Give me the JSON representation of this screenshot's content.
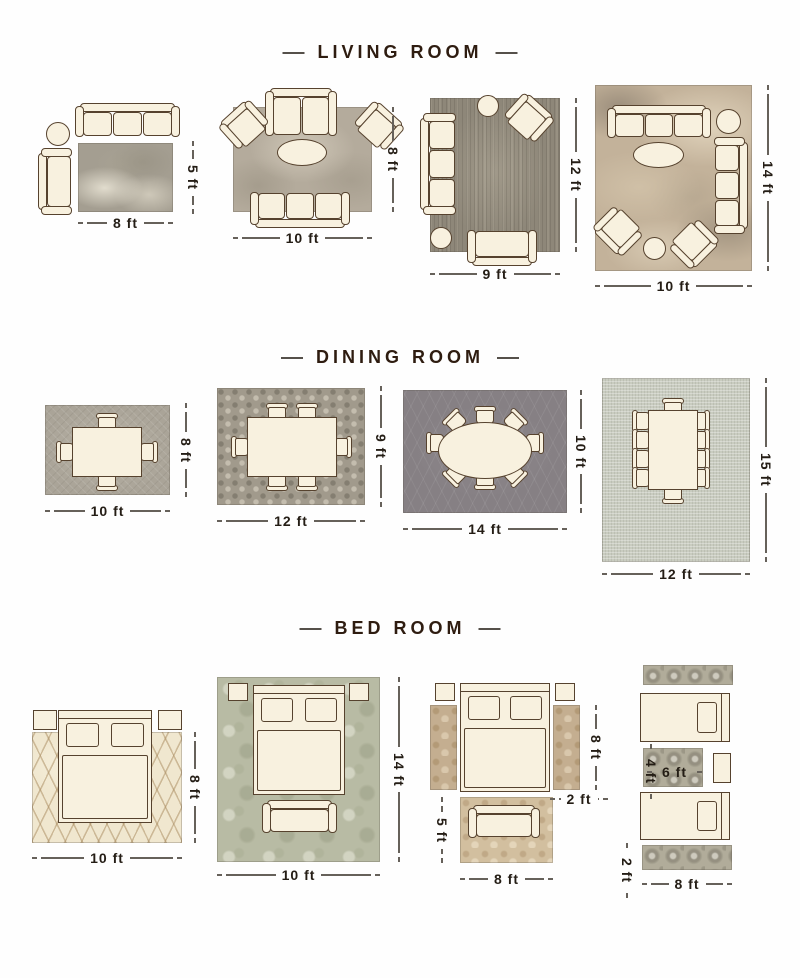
{
  "sections": [
    {
      "title": "LIVING ROOM",
      "layouts": [
        {
          "width": "8 ft",
          "height": "5 ft"
        },
        {
          "width": "10 ft",
          "height": "8 ft"
        },
        {
          "width": "9 ft",
          "height": "12 ft"
        },
        {
          "width": "10 ft",
          "height": "14 ft"
        }
      ]
    },
    {
      "title": "DINING ROOM",
      "layouts": [
        {
          "width": "10 ft",
          "height": "8 ft"
        },
        {
          "width": "12 ft",
          "height": "9 ft"
        },
        {
          "width": "14 ft",
          "height": "10 ft"
        },
        {
          "width": "12 ft",
          "height": "15 ft"
        }
      ]
    },
    {
      "title": "BED ROOM",
      "layouts": [
        {
          "width": "10 ft",
          "height": "8 ft"
        },
        {
          "width": "10 ft",
          "height": "14 ft"
        },
        {
          "width": "8 ft",
          "runner_height": "8 ft",
          "runner_width": "2 ft",
          "front_rug_height": "5 ft"
        },
        {
          "width": "8 ft",
          "mid_rug_width": "6 ft",
          "mid_rug_height": "4 ft",
          "runner_height": "2 ft"
        }
      ]
    }
  ],
  "colors": {
    "accent_brown": "#56422e",
    "cream_furniture": "#f8f1df",
    "heading_text": "#2e1c10",
    "dimension_text": "#241d15"
  }
}
